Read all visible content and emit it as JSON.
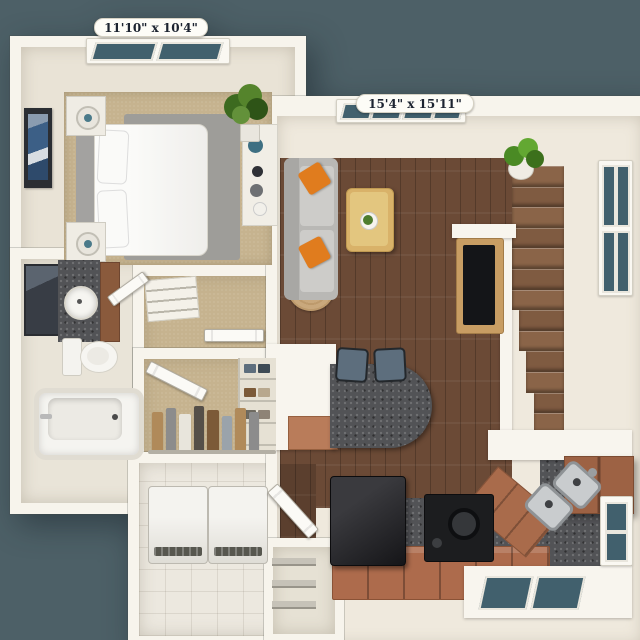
{
  "plan": {
    "type": "3d-floor-plan",
    "background_color": "#4d6067",
    "rooms": {
      "bedroom": {
        "dimensions": "11'10\" x 10'4\""
      },
      "living_room": {
        "dimensions": "15'4\" x 15'11\""
      }
    },
    "palette": {
      "wall": "#f7f4ec",
      "carpet": "#c6b38f",
      "hardwood": "#6b4a36",
      "tile": "#ece8df",
      "granite": "#525356",
      "cabinet_brown": "#ad6b4c",
      "sofa_gray": "#c3c2bf",
      "accent_pillow_orange": "#e07c1e",
      "window_glass": "#41606d",
      "label_text": "#1c2330"
    }
  }
}
